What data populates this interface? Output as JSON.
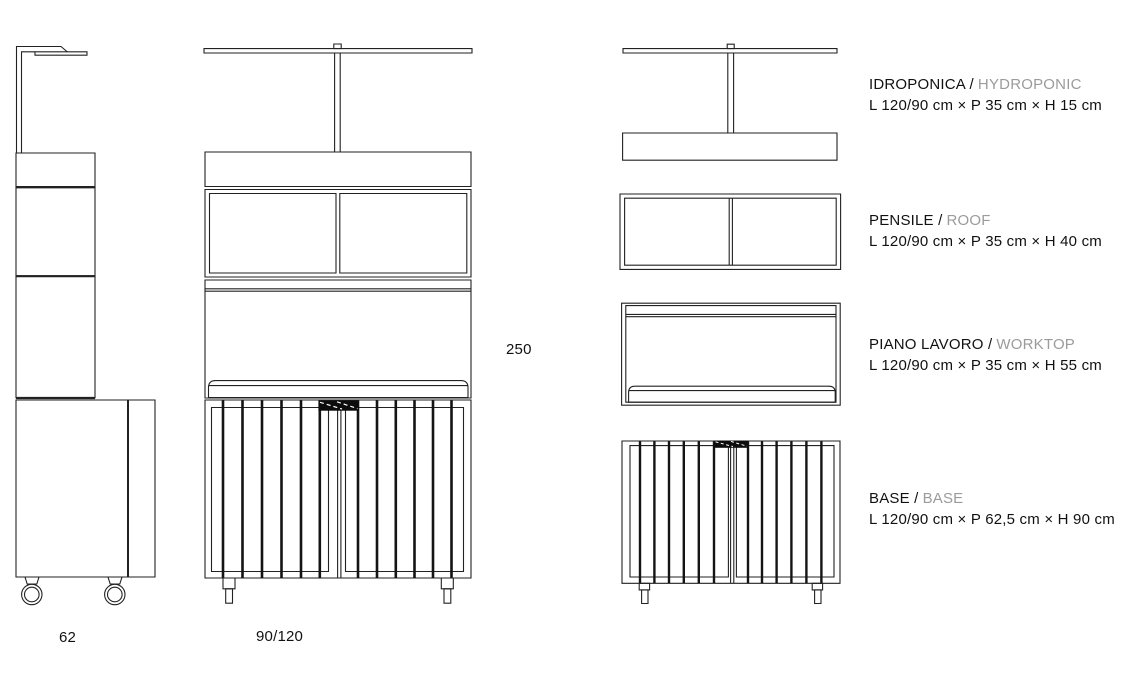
{
  "dimensions": {
    "total_height_cm": "250",
    "side_depth_cm": "62",
    "front_width_cm": "90/120"
  },
  "legend": {
    "items": [
      {
        "name_it": "IDROPONICA /",
        "name_en": "HYDROPONIC",
        "dims": "L 120/90 cm × P 35 cm × H 15 cm"
      },
      {
        "name_it": "PENSILE /",
        "name_en": "ROOF",
        "dims": "L 120/90 cm × P 35 cm × H 40 cm"
      },
      {
        "name_it": "PIANO LAVORO /",
        "name_en": "WORKTOP",
        "dims": "L 120/90 cm × P 35 cm × H 55 cm"
      },
      {
        "name_it": "BASE /",
        "name_en": "BASE",
        "dims": "L 120/90 cm × P 62,5 cm × H 90 cm"
      }
    ]
  },
  "colors": {
    "line": "#222222",
    "dark_fill": "#0c0c0c",
    "text": "#111111",
    "gray_text": "#9b9b9b",
    "background": "#ffffff"
  }
}
